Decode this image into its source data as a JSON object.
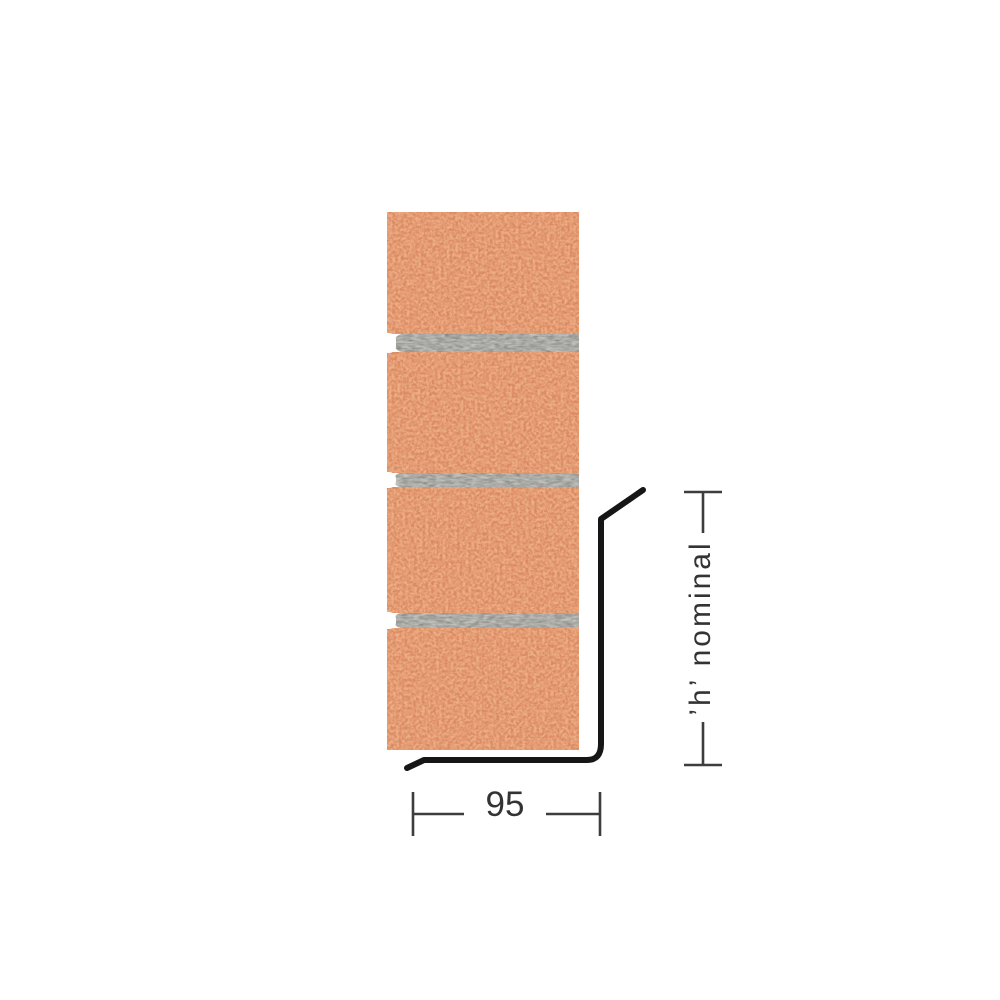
{
  "labels": {
    "width_dimension": "95",
    "height_dimension": "’h’ nominal"
  },
  "colors": {
    "background": "#ffffff",
    "brick": "#dc8a62",
    "brick_speckle_light": "#f3bb93",
    "brick_speckle_dark": "#b8663f",
    "mortar": "#9b9b97",
    "mortar_grain_light": "#c9c9c5",
    "mortar_grain_dark": "#595955",
    "lintel_line": "#161616",
    "dimension_line": "#3d3d3d",
    "label_text": "#333333"
  },
  "structure": {
    "brick_courses": 4,
    "mortar_joints": 3
  }
}
